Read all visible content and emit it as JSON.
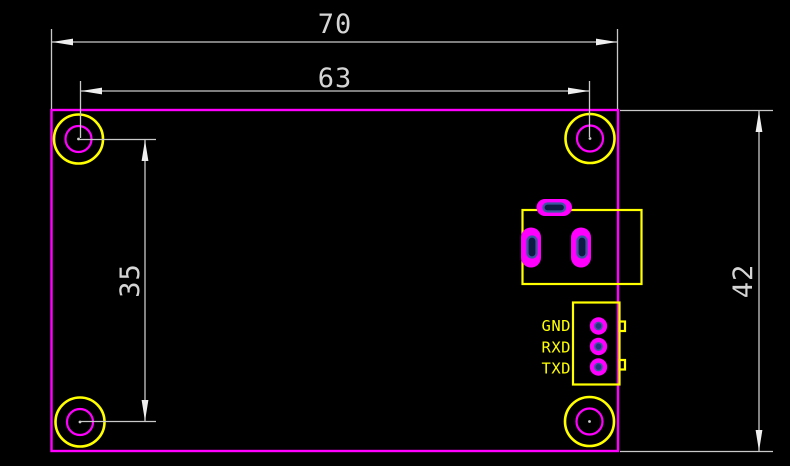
{
  "drawing": {
    "description": "PCB module outline dimension drawing",
    "background": "#000000"
  },
  "dimensions": {
    "board_width": {
      "value": "70"
    },
    "hole_span_width": {
      "value": "63"
    },
    "hole_span_height": {
      "value": "35"
    },
    "board_height": {
      "value": "42"
    }
  },
  "serial_header": {
    "pins": [
      {
        "label": "GND"
      },
      {
        "label": "RXD"
      },
      {
        "label": "TXD"
      }
    ]
  },
  "colors": {
    "board_outline": "#ff00ff",
    "component_outline": "#ffff00",
    "pad_fill": "#ff00ff",
    "drill_hole": "#24387e",
    "dimension_lines": "#c9c9c9",
    "dimension_text": "#d5d5d5",
    "background": "#000000"
  }
}
